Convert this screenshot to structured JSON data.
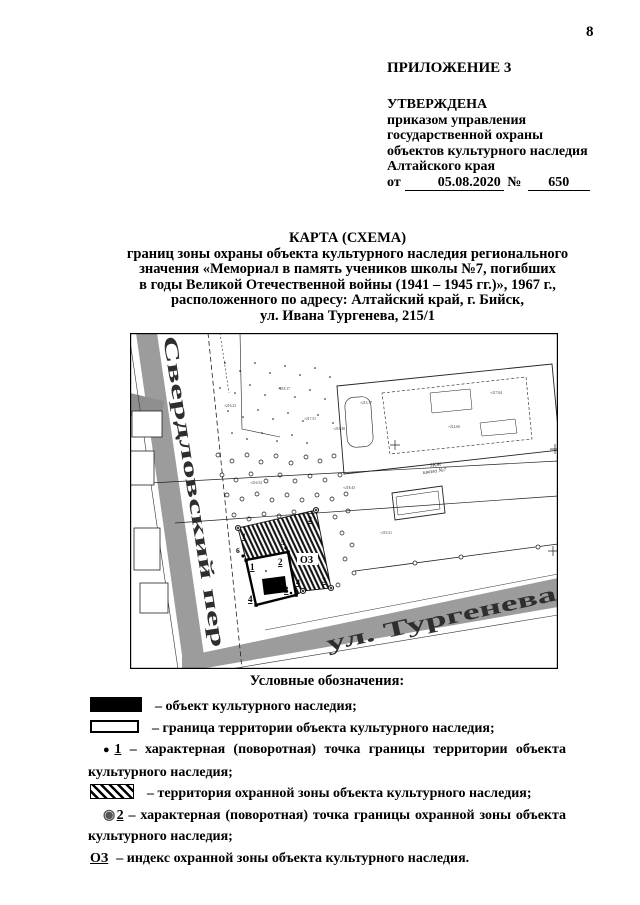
{
  "page_number": "8",
  "appendix": "ПРИЛОЖЕНИЕ 3",
  "approval": {
    "approved": "УТВЕРЖДЕНА",
    "body": "приказом управления\nгосударственной охраны\nобъектов культурного наследия\nАлтайского края",
    "from_label": "от",
    "date": "05.08.2020",
    "number_sign": "№",
    "number": "650"
  },
  "title": {
    "heading": "КАРТА (СХЕМА)",
    "subtitle": "границ зоны охраны объекта культурного наследия регионального\nзначения «Мемориал в память учеников школы №7, погибших\nв годы Великой Отечественной войны (1941 – 1945 гг.)», 1967 г.,\nрасположенного по адресу: Алтайский край, г. Бийск,\nул. Ивана Тургенева, 215/1"
  },
  "map": {
    "street_sverdlovsky": "Свердловский пер",
    "street_turgeneva": "ул. Тургенева",
    "school_line1": "3КЖ",
    "school_line2": "школа №7",
    "zone_index": "ОЗ",
    "territory_points": [
      "1",
      "2",
      "3",
      "4"
    ],
    "edge_points": [
      "5",
      "6"
    ],
    "zone_points": [
      "1",
      "2",
      "3",
      "4"
    ],
    "annotations": [
      "+218.17",
      "+216.23",
      "+217.51",
      "+218.48",
      "+213.17",
      "+216.54",
      "+218.43",
      "+219.21",
      "+214.60",
      "+217.84"
    ]
  },
  "legend": {
    "heading": "Условные обозначения:",
    "object": {
      "text": "– объект культурного наследия;"
    },
    "territory_border": {
      "text": "– граница территории объекта культурного наследия;"
    },
    "territory_point": {
      "dot": "●",
      "num": "1",
      "line1_text": "–   характерная   (поворотная)   точка   границы   территории   объекта",
      "line2": "культурного наследия;"
    },
    "zone_area": {
      "text": "– территория охранной зоны объекта культурного наследия;"
    },
    "zone_point": {
      "dot": "◉",
      "num": "2",
      "line1_text": "–   характерная   (поворотная)   точка   границы   охранной   зоны   объекта",
      "line2": "культурного наследия;"
    },
    "zone_index": {
      "sym": "ОЗ",
      "text": "– индекс охранной зоны объекта культурного наследия."
    }
  }
}
